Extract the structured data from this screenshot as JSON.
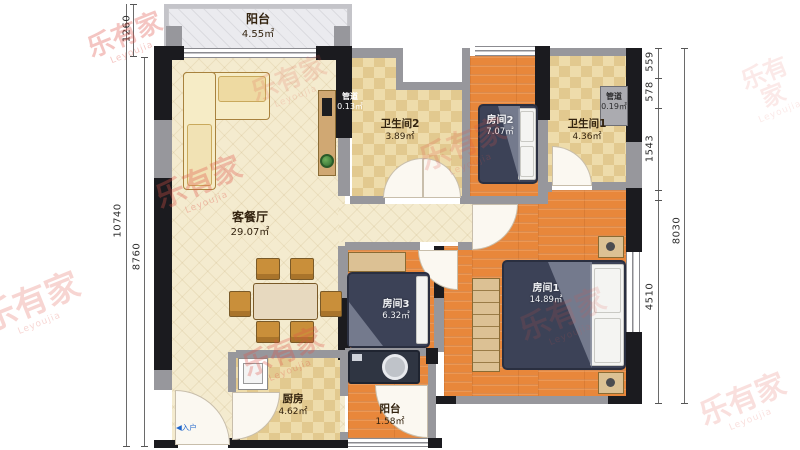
{
  "floorplan": {
    "rooms": {
      "balcony_top": {
        "name": "阳台",
        "area": "4.55㎡"
      },
      "living": {
        "name": "客餐厅",
        "area": "29.07㎡"
      },
      "bath2": {
        "name": "卫生间2",
        "area": "3.89㎡"
      },
      "duct2": {
        "name": "管道",
        "area": "0.13㎡"
      },
      "bed2": {
        "name": "房间2",
        "area": "7.07㎡"
      },
      "bath1": {
        "name": "卫生间1",
        "area": "4.36㎡"
      },
      "duct1": {
        "name": "管道",
        "area": "0.19㎡"
      },
      "bed1": {
        "name": "房间1",
        "area": "14.89㎡"
      },
      "bed3": {
        "name": "房间3",
        "area": "6.32㎡"
      },
      "kitchen": {
        "name": "厨房",
        "area": "4.62㎡"
      },
      "balcony_bottom": {
        "name": "阳台",
        "area": "1.58㎡"
      }
    },
    "dims": {
      "left": [
        "1260",
        "10740",
        "8760"
      ],
      "right": [
        "559",
        "578",
        "1543",
        "4510",
        "8030"
      ]
    },
    "entry": {
      "arrow": "◀",
      "label": "入户"
    },
    "watermark": {
      "text": "乐有家",
      "sub": "Leyoujia",
      "color": "#e05348"
    }
  }
}
